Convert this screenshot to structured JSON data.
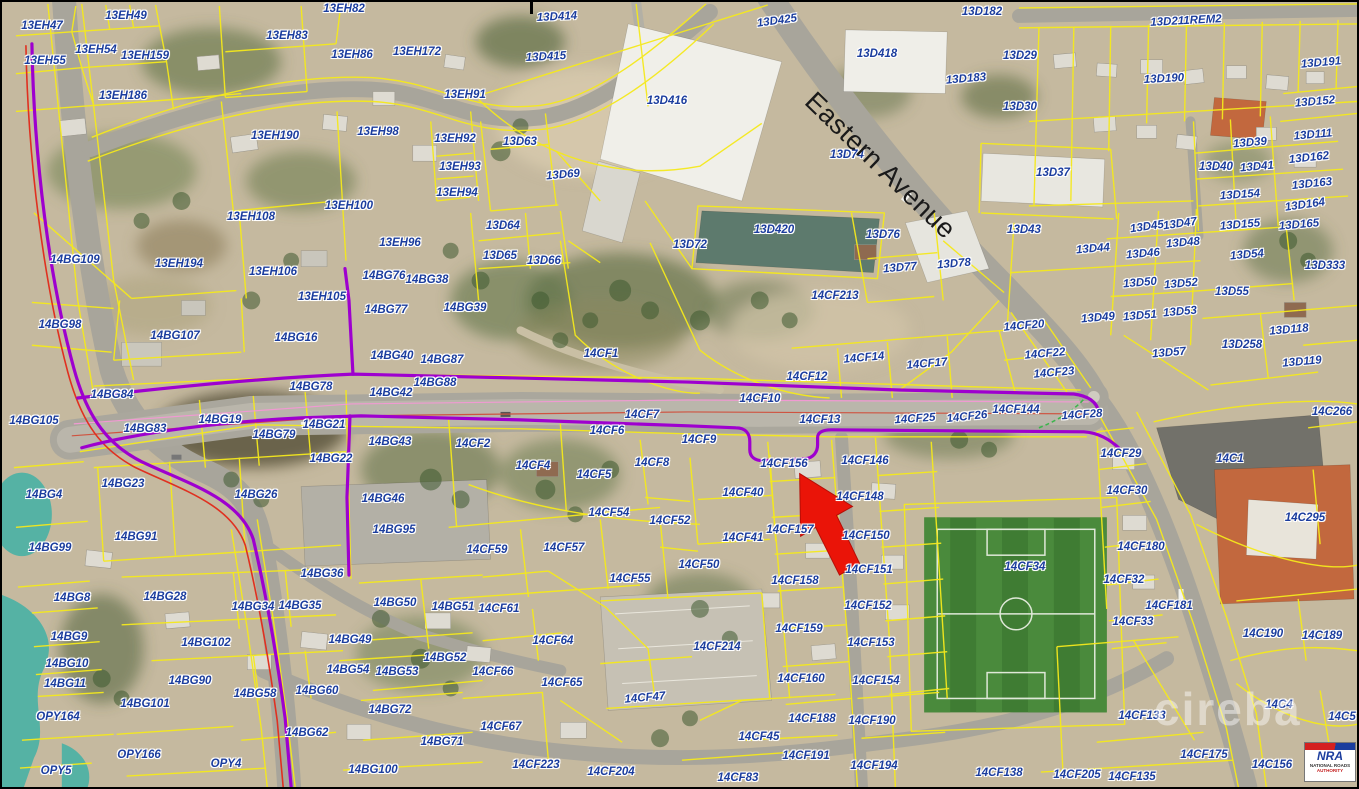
{
  "map": {
    "street_label": "Eastern Avenue",
    "watermark": "cireba",
    "logo": {
      "abbr": "NRA",
      "line1": "NATIONAL ROADS",
      "line2": "AUTHORITY"
    },
    "colors": {
      "parcel_label": "#1b3d9e",
      "parcel_line": "#f5e91c",
      "route_purple": "#9e00cf",
      "route_red": "#e03020",
      "arrow_red": "#ea1408",
      "water": "#55b2a4",
      "field_green": "#3f7c33"
    },
    "parcels": [
      [
        "13EH47",
        40,
        24
      ],
      [
        "13EH49",
        124,
        14
      ],
      [
        "13EH54",
        94,
        48
      ],
      [
        "13EH55",
        43,
        59
      ],
      [
        "13EH159",
        143,
        54
      ],
      [
        "13EH83",
        285,
        34
      ],
      [
        "13EH186",
        121,
        94
      ],
      [
        "13EH190",
        273,
        134
      ],
      [
        "13EH82",
        342,
        7
      ],
      [
        "13EH86",
        350,
        53
      ],
      [
        "13EH172",
        415,
        50
      ],
      [
        "13EH91",
        463,
        93
      ],
      [
        "13EH98",
        376,
        130
      ],
      [
        "13EH92",
        453,
        137
      ],
      [
        "13EH93",
        458,
        165
      ],
      [
        "13EH94",
        455,
        191
      ],
      [
        "13EH100",
        347,
        204
      ],
      [
        "13EH108",
        249,
        215
      ],
      [
        "13EH194",
        177,
        262
      ],
      [
        "13EH106",
        271,
        270
      ],
      [
        "13EH105",
        320,
        295
      ],
      [
        "13EH96",
        398,
        241
      ],
      [
        "13D414",
        555,
        15,
        -3
      ],
      [
        "13D415",
        544,
        55,
        -3
      ],
      [
        "13D416",
        665,
        99
      ],
      [
        "13D425",
        775,
        19,
        -8
      ],
      [
        "13D418",
        875,
        52
      ],
      [
        "13D182",
        980,
        10
      ],
      [
        "13D183",
        964,
        77,
        -5
      ],
      [
        "13D74",
        845,
        153
      ],
      [
        "13D211REM2",
        1184,
        19,
        -3
      ],
      [
        "13D29",
        1018,
        54
      ],
      [
        "13D190",
        1162,
        77,
        -3
      ],
      [
        "13D191",
        1319,
        61,
        -5
      ],
      [
        "13D30",
        1018,
        105
      ],
      [
        "13D152",
        1313,
        100,
        -5
      ],
      [
        "13D111",
        1311,
        133,
        -5
      ],
      [
        "13D39",
        1248,
        141,
        -5
      ],
      [
        "13D162",
        1307,
        156,
        -6
      ],
      [
        "13D40",
        1214,
        165
      ],
      [
        "13D41",
        1255,
        165,
        -5
      ],
      [
        "13D163",
        1310,
        182,
        -6
      ],
      [
        "13D37",
        1051,
        171
      ],
      [
        "13D154",
        1238,
        193,
        -4
      ],
      [
        "13D164",
        1303,
        203,
        -8
      ],
      [
        "13D43",
        1022,
        228
      ],
      [
        "13D45",
        1145,
        225,
        -8
      ],
      [
        "13D47",
        1178,
        222,
        -8
      ],
      [
        "13D155",
        1238,
        223,
        -5
      ],
      [
        "13D165",
        1297,
        223,
        -5
      ],
      [
        "13D44",
        1091,
        247,
        -5
      ],
      [
        "13D48",
        1181,
        241,
        -5
      ],
      [
        "13D46",
        1141,
        252,
        -5
      ],
      [
        "13D54",
        1245,
        253,
        -5
      ],
      [
        "13D333",
        1323,
        264
      ],
      [
        "13D50",
        1138,
        281,
        -5
      ],
      [
        "13D52",
        1179,
        282,
        -5
      ],
      [
        "13D55",
        1230,
        290
      ],
      [
        "13D49",
        1096,
        316,
        -5
      ],
      [
        "13D51",
        1138,
        314,
        -5
      ],
      [
        "13D53",
        1178,
        310,
        -5
      ],
      [
        "13D118",
        1287,
        328,
        -5
      ],
      [
        "13D258",
        1240,
        343
      ],
      [
        "13D57",
        1167,
        351,
        -5
      ],
      [
        "13D119",
        1300,
        360,
        -5
      ],
      [
        "13D63",
        518,
        140
      ],
      [
        "13D69",
        561,
        173,
        -5
      ],
      [
        "13D64",
        501,
        224
      ],
      [
        "13D65",
        498,
        254
      ],
      [
        "13D66",
        542,
        259
      ],
      [
        "13D72",
        688,
        243
      ],
      [
        "13D420",
        772,
        228
      ],
      [
        "13D76",
        881,
        233
      ],
      [
        "13D77",
        898,
        266,
        -5
      ],
      [
        "13D78",
        952,
        262,
        -5
      ],
      [
        "14CF213",
        833,
        294
      ],
      [
        "14CF20",
        1022,
        324,
        -5
      ],
      [
        "14CF22",
        1043,
        352,
        -5
      ],
      [
        "14CF23",
        1052,
        371,
        -5
      ],
      [
        "14CF1",
        599,
        352
      ],
      [
        "14CF12",
        805,
        375
      ],
      [
        "14CF14",
        862,
        356,
        -5
      ],
      [
        "14CF17",
        925,
        362,
        -5
      ],
      [
        "14CF10",
        758,
        397
      ],
      [
        "14CF7",
        640,
        413
      ],
      [
        "14CF6",
        605,
        429
      ],
      [
        "14CF9",
        697,
        438
      ],
      [
        "14CF13",
        818,
        418
      ],
      [
        "14CF25",
        913,
        417,
        -4
      ],
      [
        "14CF26",
        965,
        415,
        -6
      ],
      [
        "14CF144",
        1014,
        408
      ],
      [
        "14CF28",
        1080,
        413,
        -4
      ],
      [
        "14BG109",
        73,
        258
      ],
      [
        "14BG98",
        58,
        323
      ],
      [
        "14BG107",
        173,
        334
      ],
      [
        "14BG16",
        294,
        336
      ],
      [
        "14BG76",
        382,
        274
      ],
      [
        "14BG38",
        425,
        278
      ],
      [
        "14BG77",
        384,
        308
      ],
      [
        "14BG39",
        463,
        306
      ],
      [
        "14BG40",
        390,
        354
      ],
      [
        "14BG87",
        440,
        358
      ],
      [
        "14BG88",
        433,
        381
      ],
      [
        "14BG42",
        389,
        391
      ],
      [
        "14BG78",
        309,
        385
      ],
      [
        "14BG84",
        110,
        393
      ],
      [
        "14BG105",
        32,
        419
      ],
      [
        "14BG83",
        143,
        427
      ],
      [
        "14BG19",
        218,
        418
      ],
      [
        "14BG79",
        272,
        433
      ],
      [
        "14BG21",
        322,
        423
      ],
      [
        "14BG22",
        329,
        457
      ],
      [
        "14BG43",
        388,
        440
      ],
      [
        "14BG4",
        42,
        493
      ],
      [
        "14BG23",
        121,
        482
      ],
      [
        "14BG26",
        254,
        493
      ],
      [
        "14BG91",
        134,
        535
      ],
      [
        "14BG99",
        48,
        546
      ],
      [
        "14BG46",
        381,
        497
      ],
      [
        "14BG95",
        392,
        528
      ],
      [
        "14BG36",
        320,
        572
      ],
      [
        "14BG8",
        70,
        596
      ],
      [
        "14BG28",
        163,
        595
      ],
      [
        "14BG34",
        251,
        605
      ],
      [
        "14BG35",
        298,
        604
      ],
      [
        "14BG9",
        67,
        635
      ],
      [
        "14BG102",
        204,
        641
      ],
      [
        "14BG10",
        65,
        662
      ],
      [
        "14BG11",
        63,
        682
      ],
      [
        "14BG90",
        188,
        679
      ],
      [
        "14BG58",
        253,
        692
      ],
      [
        "14BG60",
        315,
        689
      ],
      [
        "14BG101",
        143,
        702
      ],
      [
        "14BG62",
        305,
        731
      ],
      [
        "14BG50",
        393,
        601
      ],
      [
        "14BG51",
        451,
        605
      ],
      [
        "14BG49",
        348,
        638
      ],
      [
        "14BG52",
        443,
        656
      ],
      [
        "14BG53",
        395,
        670
      ],
      [
        "14BG54",
        346,
        668
      ],
      [
        "14BG72",
        388,
        708
      ],
      [
        "14BG71",
        440,
        740
      ],
      [
        "14BG100",
        371,
        768
      ],
      [
        "OPY164",
        56,
        715
      ],
      [
        "OPY166",
        137,
        753
      ],
      [
        "OPY4",
        224,
        762
      ],
      [
        "OPY5",
        54,
        769
      ],
      [
        "14CF2",
        471,
        442
      ],
      [
        "14CF4",
        531,
        464
      ],
      [
        "14CF5",
        592,
        473
      ],
      [
        "14CF8",
        650,
        461
      ],
      [
        "14CF54",
        607,
        511
      ],
      [
        "14CF52",
        668,
        519
      ],
      [
        "14CF59",
        485,
        548
      ],
      [
        "14CF57",
        562,
        546
      ],
      [
        "14CF55",
        628,
        577
      ],
      [
        "14CF61",
        497,
        607
      ],
      [
        "14CF64",
        551,
        639
      ],
      [
        "14CF66",
        491,
        670
      ],
      [
        "14CF65",
        560,
        681
      ],
      [
        "14CF47",
        643,
        696,
        -5
      ],
      [
        "14CF67",
        499,
        725
      ],
      [
        "14CF223",
        534,
        763
      ],
      [
        "14CF204",
        609,
        770
      ],
      [
        "14CF214",
        715,
        645
      ],
      [
        "14CF156",
        782,
        462
      ],
      [
        "14CF146",
        863,
        459
      ],
      [
        "14CF40",
        741,
        491
      ],
      [
        "14CF148",
        858,
        495
      ],
      [
        "14CF41",
        741,
        536
      ],
      [
        "14CF157",
        788,
        528
      ],
      [
        "14CF150",
        864,
        534
      ],
      [
        "14CF50",
        697,
        563
      ],
      [
        "14CF151",
        867,
        568
      ],
      [
        "14CF158",
        793,
        579
      ],
      [
        "14CF152",
        866,
        604
      ],
      [
        "14CF159",
        797,
        627
      ],
      [
        "14CF153",
        869,
        641
      ],
      [
        "14CF160",
        799,
        677
      ],
      [
        "14CF154",
        874,
        679
      ],
      [
        "14CF188",
        810,
        717
      ],
      [
        "14CF190",
        870,
        719
      ],
      [
        "14CF45",
        757,
        735
      ],
      [
        "14CF191",
        804,
        754
      ],
      [
        "14CF194",
        872,
        764
      ],
      [
        "14CF83",
        736,
        776
      ],
      [
        "14CF138",
        997,
        771
      ],
      [
        "14CF34",
        1023,
        565
      ],
      [
        "14CF29",
        1119,
        452
      ],
      [
        "14CF30",
        1125,
        489
      ],
      [
        "14CF180",
        1139,
        545
      ],
      [
        "14CF32",
        1122,
        578
      ],
      [
        "14CF33",
        1131,
        620
      ],
      [
        "14CF181",
        1167,
        604
      ],
      [
        "14CF133",
        1140,
        714
      ],
      [
        "14CF175",
        1202,
        753
      ],
      [
        "14CF205",
        1075,
        773
      ],
      [
        "14CF135",
        1130,
        775
      ],
      [
        "14C1",
        1228,
        457
      ],
      [
        "14C266",
        1330,
        410
      ],
      [
        "14C295",
        1303,
        516
      ],
      [
        "14C190",
        1261,
        632
      ],
      [
        "14C189",
        1320,
        634
      ],
      [
        "14C4",
        1277,
        703
      ],
      [
        "14C5",
        1340,
        715
      ],
      [
        "14C154",
        1331,
        750
      ],
      [
        "14C156",
        1270,
        763
      ]
    ]
  }
}
